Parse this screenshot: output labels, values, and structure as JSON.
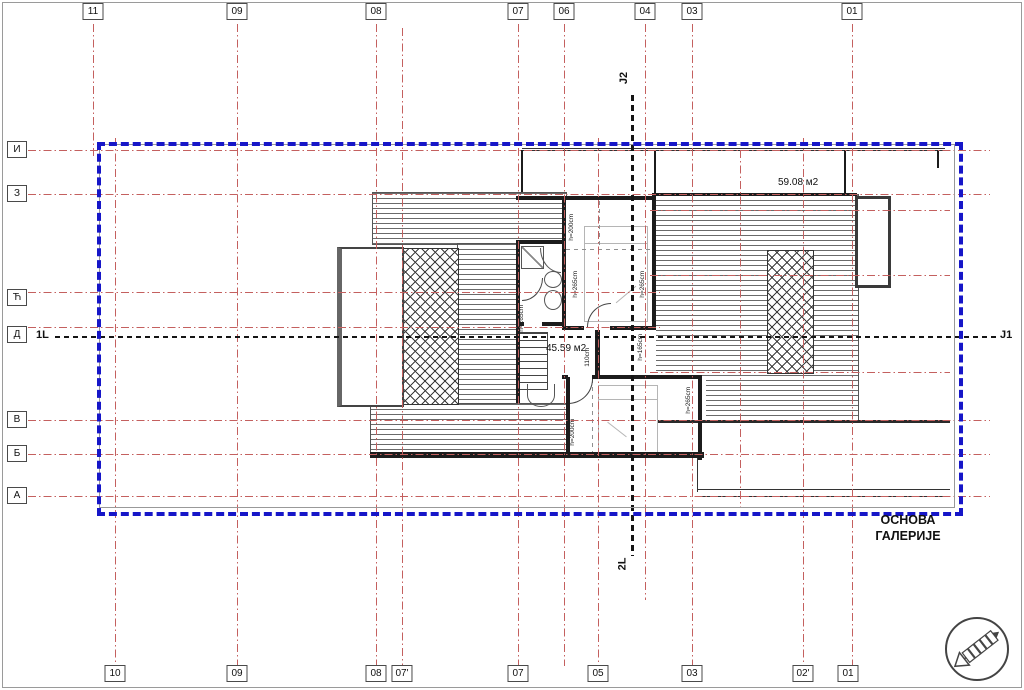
{
  "document": {
    "title_line1": "ОСНОВА",
    "title_line2": "ГАЛЕРИЈЕ"
  },
  "grid": {
    "top": [
      "11",
      "09",
      "08",
      "07",
      "06",
      "04",
      "03",
      "01"
    ],
    "bottom": [
      "10",
      "09",
      "08",
      "07'",
      "07",
      "05",
      "03",
      "02'",
      "01"
    ],
    "left": [
      "И",
      "З",
      "Ћ",
      "Д",
      "В",
      "Б",
      "А"
    ]
  },
  "sections": {
    "left_label": "1L",
    "right_label": "J1",
    "top_label": "J2",
    "bottom_label": "2L"
  },
  "areas": {
    "gallery_area": "59.08 м2",
    "hall_area": "45.59 м2"
  },
  "room_heights": [
    "h=200cm",
    "h=265cm",
    "h=265cm",
    "h=265cm",
    "h=165cm",
    "110cm",
    "h=200cm",
    "h=265cm"
  ],
  "colors": {
    "grid_line": "#c4605f",
    "boundary": "#1616c8",
    "section_line": "#151515",
    "wall": "#1c1c1c"
  }
}
